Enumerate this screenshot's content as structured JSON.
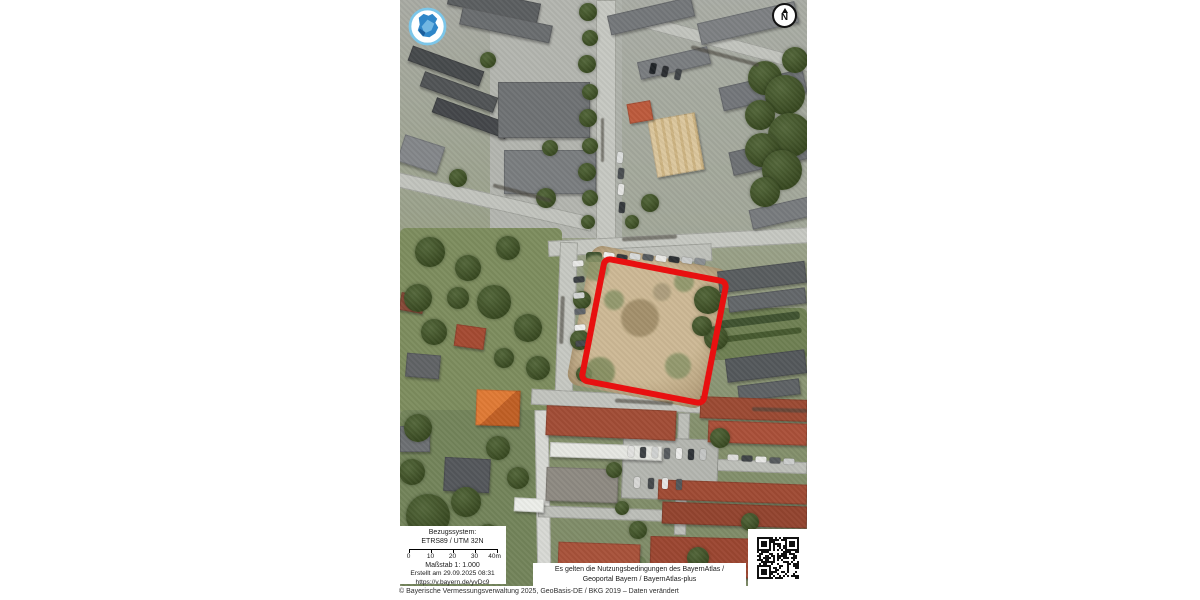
{
  "map": {
    "north_label": "N",
    "icons": {
      "logo": "bayernatlas-bavaria-logo",
      "north": "north-arrow",
      "qr": "qr-code"
    },
    "colors": {
      "parcel_outline": "#e81010",
      "logo_blue": "#2f86c8",
      "logo_ring": "#7cc6e9"
    }
  },
  "scale_box": {
    "ref_system_label": "Bezugssystem:",
    "ref_system_value": "ETRS89 / UTM 32N",
    "ticks": [
      "0",
      "10",
      "20",
      "30",
      "40m"
    ],
    "scale_label": "Maßstab 1: 1.000",
    "created_label": "Erstellt am 29.09.2025 08:31",
    "short_url": "https://v.bayern.de/yvDc9"
  },
  "disclaimer": {
    "line1": "Es gelten die Nutzungsbedingungen des BayernAtlas /",
    "line2": "Geoportal Bayern / BayernAtlas-plus"
  },
  "footer": {
    "copyright": "© Bayerische Vermessungsverwaltung 2025, GeoBasis-DE / BKG 2019 – Daten verändert"
  }
}
